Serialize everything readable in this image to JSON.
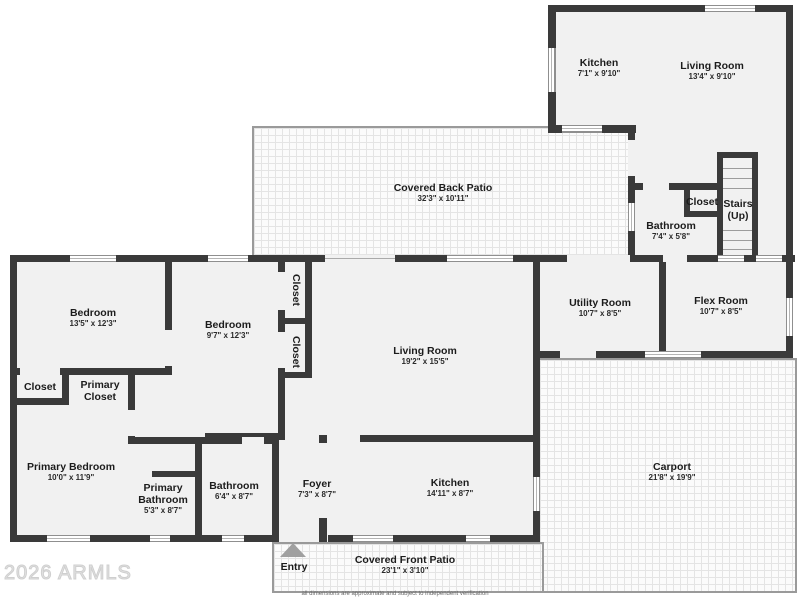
{
  "watermark": "2026 ARMLS",
  "disclaimer": "all dimensions are approximate and subject to independent verification",
  "colors": {
    "wall": "#3a3a3a",
    "room_fill": "#f1f1f1",
    "hatch_line": "#e4e4e4",
    "outdoor_edge": "#9a9a9a",
    "entry_arrow": "#a0a0a0",
    "watermark": "#e3e3e3"
  },
  "rooms": {
    "kitchen_upper": {
      "name": "Kitchen",
      "dims": "7'1\" x 9'10\""
    },
    "living_upper": {
      "name": "Living Room",
      "dims": "13'4\" x 9'10\""
    },
    "back_patio": {
      "name": "Covered Back Patio",
      "dims": "32'3\" x 10'11\""
    },
    "bathroom_upper": {
      "name": "Bathroom",
      "dims": "7'4\" x 5'8\""
    },
    "closet_upper": {
      "name": "Closet"
    },
    "stairs": {
      "name": "Stairs",
      "sub": "(Up)"
    },
    "bedroom1": {
      "name": "Bedroom",
      "dims": "13'5\" x 12'3\""
    },
    "bedroom2": {
      "name": "Bedroom",
      "dims": "9'7\" x 12'3\""
    },
    "closet_v1": {
      "name": "Closet"
    },
    "closet_v2": {
      "name": "Closet"
    },
    "living_main": {
      "name": "Living Room",
      "dims": "19'2\" x 15'5\""
    },
    "utility": {
      "name": "Utility Room",
      "dims": "10'7\" x 8'5\""
    },
    "flex": {
      "name": "Flex Room",
      "dims": "10'7\" x 8'5\""
    },
    "closet_small": {
      "name": "Closet"
    },
    "primary_closet": {
      "name": "Primary Closet"
    },
    "primary_bedroom": {
      "name": "Primary Bedroom",
      "dims": "10'0\" x 11'9\""
    },
    "primary_bathroom": {
      "name": "Primary Bathroom",
      "dims": "5'3\" x 8'7\""
    },
    "bathroom_main": {
      "name": "Bathroom",
      "dims": "6'4\" x 8'7\""
    },
    "foyer": {
      "name": "Foyer",
      "dims": "7'3\" x 8'7\""
    },
    "kitchen_main": {
      "name": "Kitchen",
      "dims": "14'11\" x 8'7\""
    },
    "carport": {
      "name": "Carport",
      "dims": "21'8\" x 19'9\""
    },
    "front_patio": {
      "name": "Covered Front Patio",
      "dims": "23'1\" x 3'10\""
    },
    "entry": {
      "name": "Entry"
    }
  }
}
